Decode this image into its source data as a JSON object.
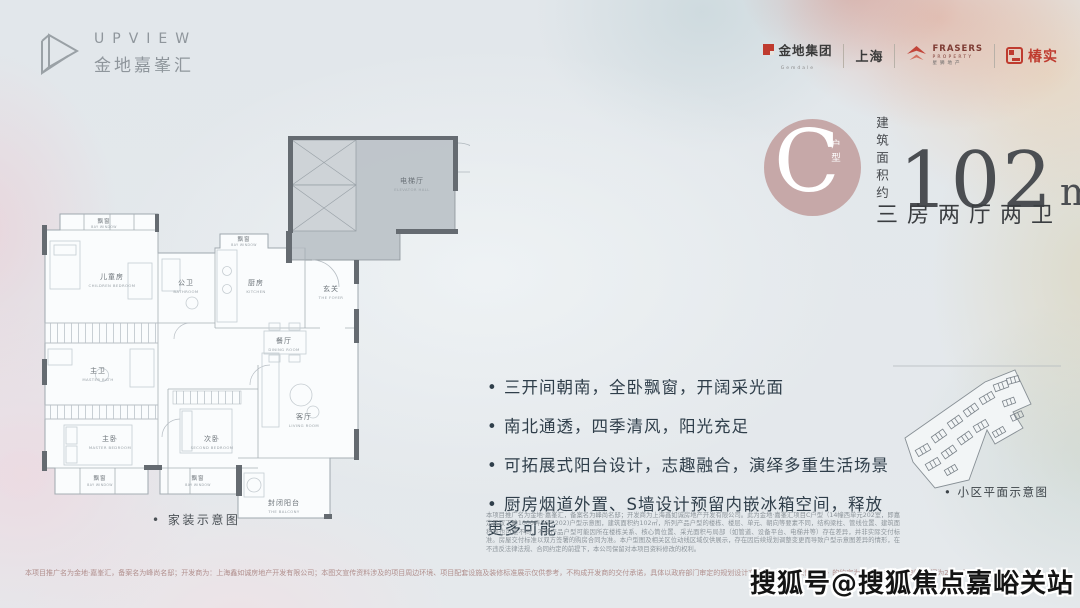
{
  "colors": {
    "accent_red": "#bf3b2f",
    "badge_pink": "#c6a8a8",
    "ink": "#3a3d40"
  },
  "header": {
    "logo": {
      "name": "UPVIEW",
      "cn": "金地嘉峯汇"
    },
    "partners": {
      "gemdale_label": "金地集团",
      "gemdale_sub": "Gemdale",
      "shanghai_label": "上海",
      "frasers_name": "FRASERS",
      "frasers_property": "PROPERTY",
      "frasers_cn": "星狮地产",
      "chunshi_label": "椿实"
    }
  },
  "unit": {
    "badge_letter": "C",
    "badge_label": "户型",
    "area_prefix": "建筑面积约",
    "area_value": "102",
    "area_unit_base": "m",
    "area_unit_sup": "2",
    "layout_text": "三房两厅两卫"
  },
  "features": [
    "三开间朝南，全卧飘窗，开阔采光面",
    "南北通透，四季清风，阳光充足",
    "可拓展式阳台设计，志趣融合，演绎多重生活场景",
    "厨房烟道外置、S墙设计预留内嵌冰箱空间，释放更多可能"
  ],
  "floorplan": {
    "caption": "家装示意图",
    "rooms": {
      "elevator_hall": {
        "cn": "电梯厅",
        "en": "ELEVATOR HALL"
      },
      "foyer": {
        "cn": "玄关",
        "en": "THE FOYER"
      },
      "kitchen": {
        "cn": "厨房",
        "en": "KITCHEN"
      },
      "bathroom": {
        "cn": "公卫",
        "en": "BATHROOM"
      },
      "children": {
        "cn": "儿童房",
        "en": "CHILDREN BEDROOM"
      },
      "master_bath": {
        "cn": "主卫",
        "en": "MASTER BATH"
      },
      "dining": {
        "cn": "餐厅",
        "en": "DINING ROOM"
      },
      "living": {
        "cn": "客厅",
        "en": "LIVING ROOM"
      },
      "master": {
        "cn": "主卧",
        "en": "MASTER BEDROOM"
      },
      "second": {
        "cn": "次卧",
        "en": "SECOND BEDROOM"
      },
      "balcony": {
        "cn": "封闭阳台",
        "en": "THE BALCONY"
      },
      "bay": {
        "cn": "飘窗",
        "en": "BAY WINDOW"
      }
    }
  },
  "siteplan": {
    "caption": "小区平面示意图"
  },
  "disclaimer": {
    "main": "本项目推广名为金地·嘉峯汇，备案名为峰尚名邸；开发商为上海鑫如诚房地产开发有限公司。此为金地·嘉峯汇项目C户型（14幢西单元202室，即嘉定区双丁路1000弄56号202)户型示意图，建筑面积约102㎡，所列产品户型的楼栋、楼层、单元、朝向等要素不同，结构梁柱、管线位置、建筑面积等也可能不同，不同产品户型可能因所在楼栋关系、核心筒位置、采光面积与局部（如管道、设备平台、电梯井等）存在差异，并非实际交付标准。房屋交付标准以双方签署的购房合同为准。本户型图及相关区位动线区域仅供展示，存在因后续规划调整变更而导致户型示意图差异的情形，在不违反法律法规、合同约定的前提下，本公司保留对本项目资料修改的权利。",
    "bottom": "本项目推广名为金地·嘉峯汇，备案名为峰尚名邸；开发商为：上海鑫如诚房地产开发有限公司；本图文宣传资料涉及的项目周边环境、项目配套设施及装修标准展示仅供参考，不构成开发商的交付承诺，具体以政府部门审定的规划设计文件及《商品房预售合同》的约定为准。本宣传资料制作时间为2024年3月。"
  },
  "watermark": "搜狐号@搜狐焦点嘉峪关站"
}
